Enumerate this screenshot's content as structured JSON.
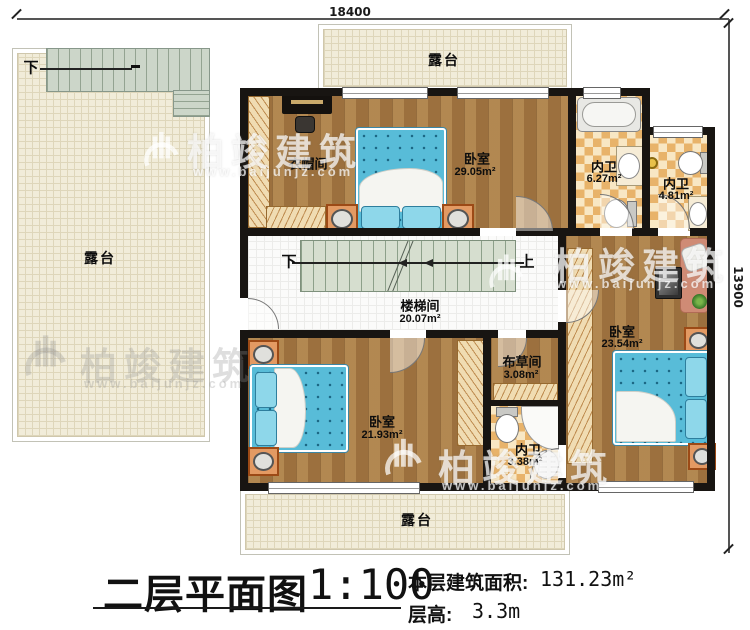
{
  "title": {
    "main": "二层平面图",
    "scale": "1:100",
    "area_label": "本层建筑面积:",
    "area_value": "131.23m²",
    "floor_height_label": "层高:",
    "floor_height_value": "3.3m"
  },
  "dimensions": {
    "width_mm": "18400",
    "height_mm": "13900"
  },
  "watermark": {
    "brand": "柏竣建筑",
    "site": "www.baijunjz.com"
  },
  "stair_labels": {
    "outdoor_down": "下",
    "down": "下",
    "up": "上"
  },
  "rooms": {
    "terrace_left": {
      "label": "露台"
    },
    "terrace_top": {
      "label": "露台"
    },
    "terrace_bottom": {
      "label": "露台"
    },
    "cloakroom": {
      "label": "衣帽间"
    },
    "bedroom_top": {
      "label": "卧室",
      "area": "29.05m²"
    },
    "bath_ensuite_1": {
      "label": "内卫",
      "area": "6.27m²"
    },
    "bath_ensuite_2": {
      "label": "内卫",
      "area": "4.81m²"
    },
    "stairwell": {
      "label": "楼梯间",
      "area": "20.07m²"
    },
    "bedroom_right": {
      "label": "卧室",
      "area": "23.54m²"
    },
    "linen_room": {
      "label": "布草间",
      "area": "3.08m²"
    },
    "bath_small": {
      "label": "内卫",
      "area": "3.38m²"
    },
    "bedroom_bottom": {
      "label": "卧室",
      "area": "21.93m²"
    }
  }
}
